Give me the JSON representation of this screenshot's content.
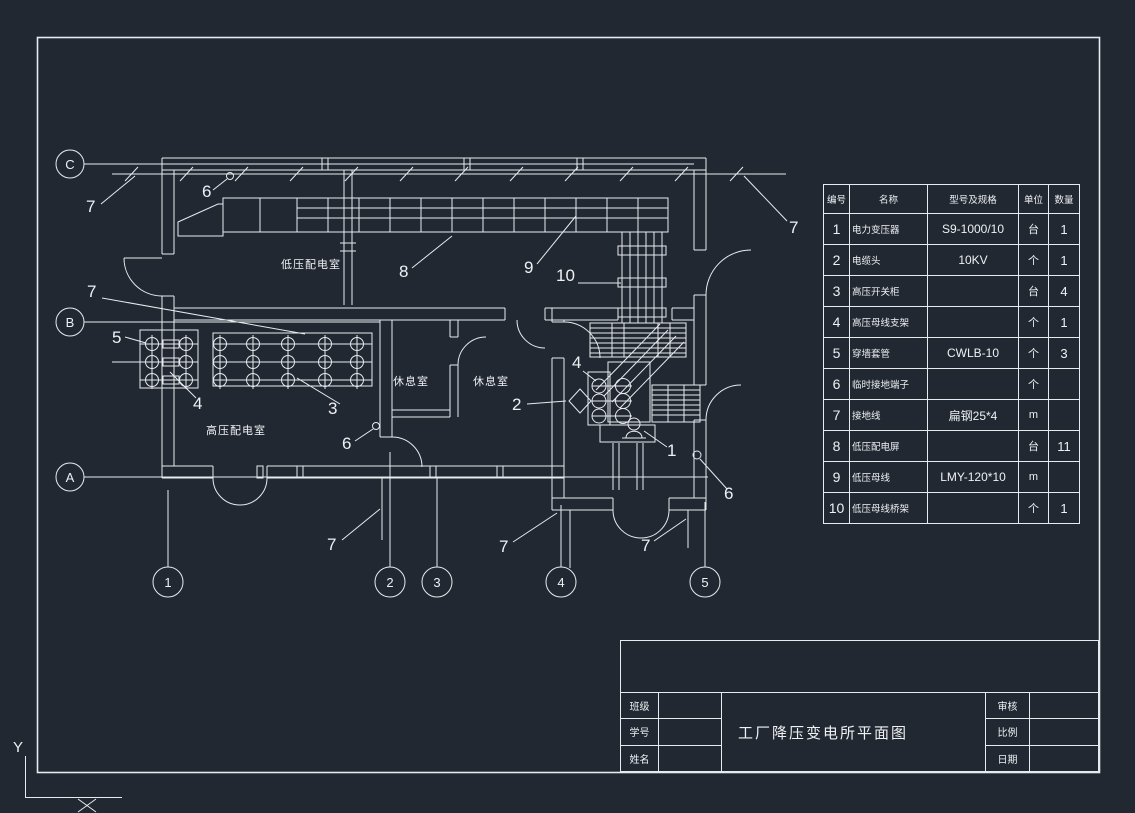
{
  "colors": {
    "background": "#222831",
    "line": "#e7ebee"
  },
  "plan": {
    "room_labels": [
      "低压配电室",
      "高压配电室",
      "休息室",
      "休息室"
    ],
    "row_bubbles": [
      "C",
      "B",
      "A"
    ],
    "col_bubbles": [
      "1",
      "2",
      "3",
      "4",
      "5"
    ],
    "callouts": [
      "7",
      "6",
      "8",
      "9",
      "10",
      "7",
      "5",
      "4",
      "3",
      "6",
      "2",
      "4",
      "1",
      "6",
      "7",
      "7",
      "7",
      "7"
    ],
    "ucs_y": "Y"
  },
  "table": {
    "headers": [
      "编号",
      "名称",
      "型号及规格",
      "单位",
      "数量"
    ],
    "rows": [
      {
        "no": "1",
        "name": "电力变压器",
        "model": "S9-1000/10",
        "unit": "台",
        "qty": "1"
      },
      {
        "no": "2",
        "name": "电缆头",
        "model": "10KV",
        "unit": "个",
        "qty": "1"
      },
      {
        "no": "3",
        "name": "高压开关柜",
        "model": "",
        "unit": "台",
        "qty": "4"
      },
      {
        "no": "4",
        "name": "高压母线支架",
        "model": "",
        "unit": "个",
        "qty": "1"
      },
      {
        "no": "5",
        "name": "穿墙套管",
        "model": "CWLB-10",
        "unit": "个",
        "qty": "3"
      },
      {
        "no": "6",
        "name": "临时接地端子",
        "model": "",
        "unit": "个",
        "qty": ""
      },
      {
        "no": "7",
        "name": "接地线",
        "model": "扁钢25*4",
        "unit": "m",
        "qty": ""
      },
      {
        "no": "8",
        "name": "低压配电屏",
        "model": "",
        "unit": "台",
        "qty": "11"
      },
      {
        "no": "9",
        "name": "低压母线",
        "model": "LMY-120*10",
        "unit": "m",
        "qty": ""
      },
      {
        "no": "10",
        "name": "低压母线桥架",
        "model": "",
        "unit": "个",
        "qty": "1"
      }
    ]
  },
  "title_block": {
    "title": "工厂降压变电所平面图",
    "left_labels": [
      "班级",
      "学号",
      "姓名"
    ],
    "right_labels": [
      "审核",
      "比例",
      "日期"
    ]
  }
}
